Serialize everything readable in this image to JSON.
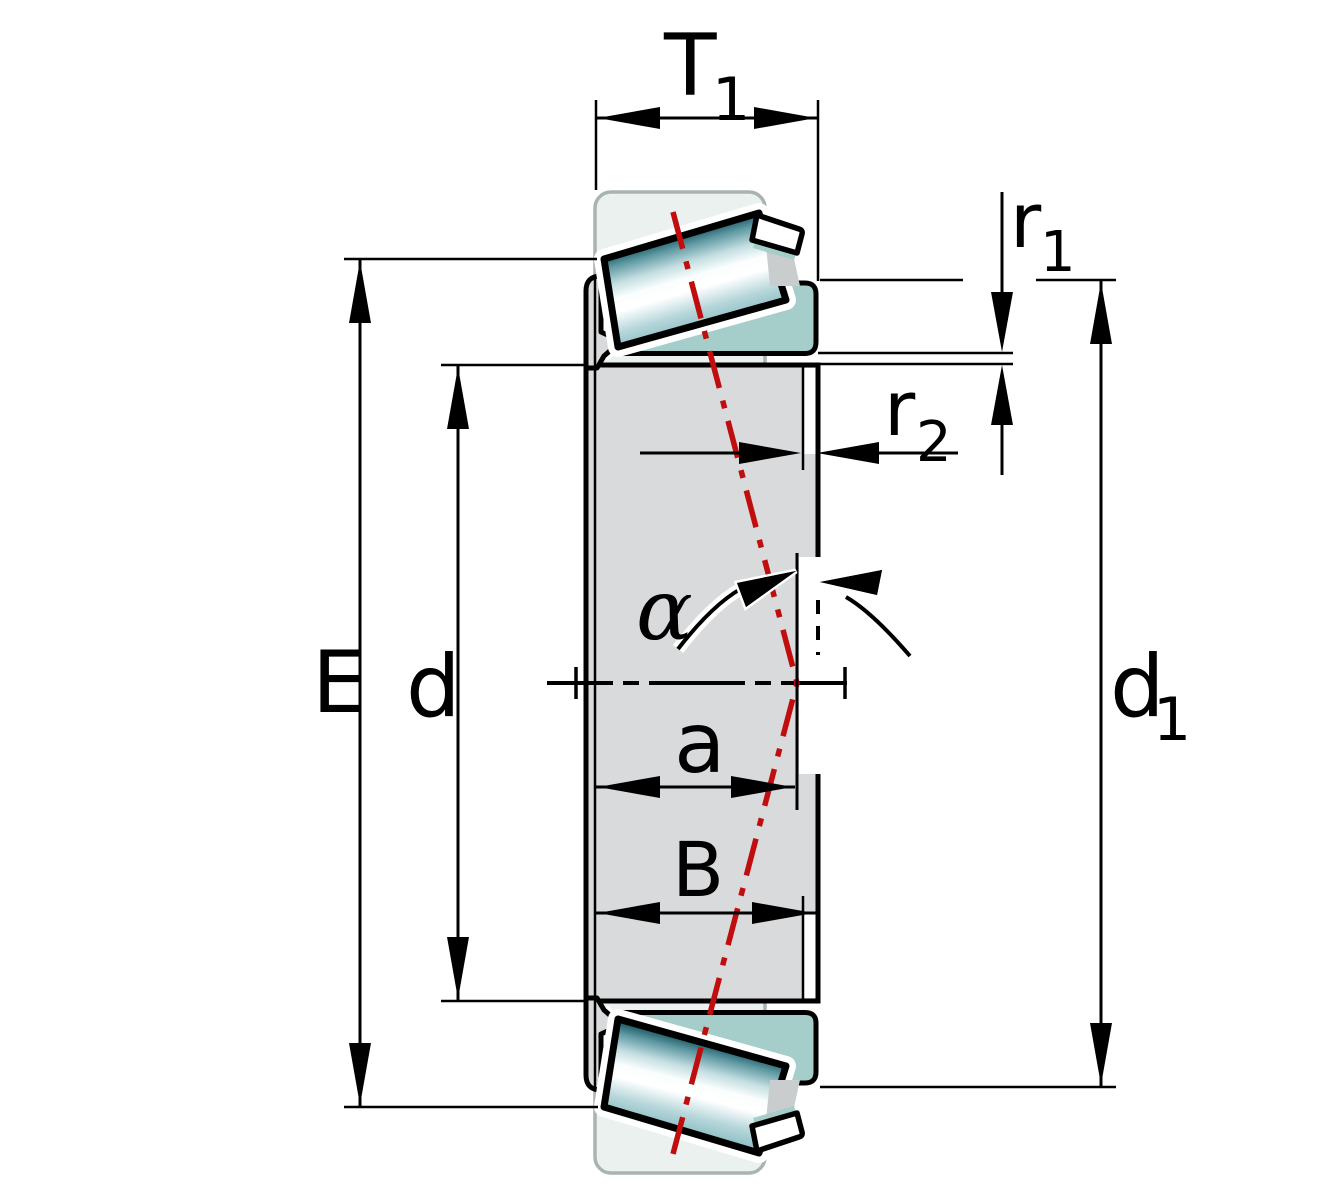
{
  "figure": {
    "kind": "technical-drawing",
    "subject": "Tapered roller bearing cross-section dimension drawing",
    "labels": {
      "T1": {
        "main": "T",
        "sub": "1"
      },
      "r1": {
        "main": "r",
        "sub": "1"
      },
      "r2": {
        "main": "r",
        "sub": "2"
      },
      "d1": {
        "main": "d",
        "sub": "1"
      },
      "E": "E",
      "d": "d",
      "a": "a",
      "B": "B",
      "alpha": "α"
    },
    "colors": {
      "background": "#ffffff",
      "outline": "#000000",
      "section_teal": "#a5cdc9",
      "body_gray": "#d9dadb",
      "wedge_gray": "#c9cdcd",
      "ghost_fill": "#eaf1ee",
      "ghost_border": "#a9b4b1",
      "axis_red": "#c00d0d",
      "roller_gradient": [
        "#1c5a67",
        "#5f99a2",
        "#c3dee1",
        "#fbfefe",
        "#ffffff",
        "#b5d6da",
        "#8fc0c6"
      ]
    }
  }
}
